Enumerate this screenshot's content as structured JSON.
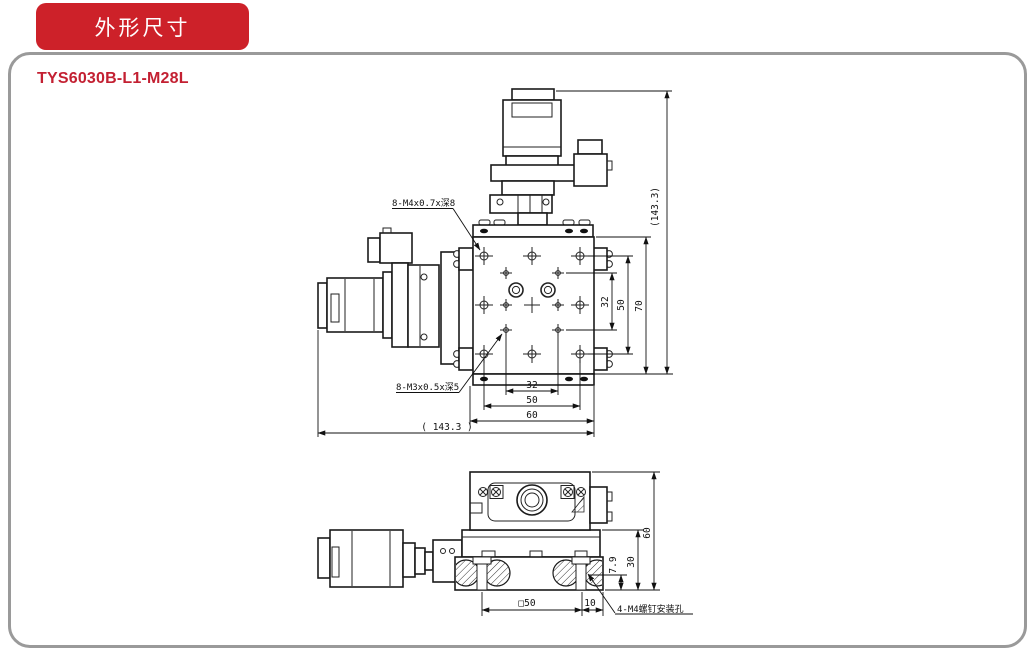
{
  "banner": {
    "label": "外形尺寸"
  },
  "model_title": "TYS6030B-L1-M28L",
  "colors": {
    "banner_red": "#cd2129",
    "model_red": "#c32032",
    "panel_border_gray": "#9a9a9a",
    "drawing_line": "#1a1a1a"
  },
  "front_view": {
    "callout_top": "8-M4x0.7x深8",
    "callout_bottom": "8-M3x0.5x深5",
    "dim_overall_height": "(143.3)",
    "dim_overall_width": "( 143.3 )",
    "dims_right": {
      "inner": "32",
      "middle": "50",
      "outer": "70"
    },
    "dims_bottom": {
      "inner": "32",
      "middle": "50",
      "outer": "60"
    }
  },
  "side_view": {
    "callout_mount_holes": "4-M4螺钉安装孔",
    "dims_right": {
      "total_height": "60",
      "base_height": "30",
      "screw_seat": "7.9"
    },
    "dims_bottom": {
      "square_spacing": "□50",
      "edge_offset": "10"
    }
  }
}
